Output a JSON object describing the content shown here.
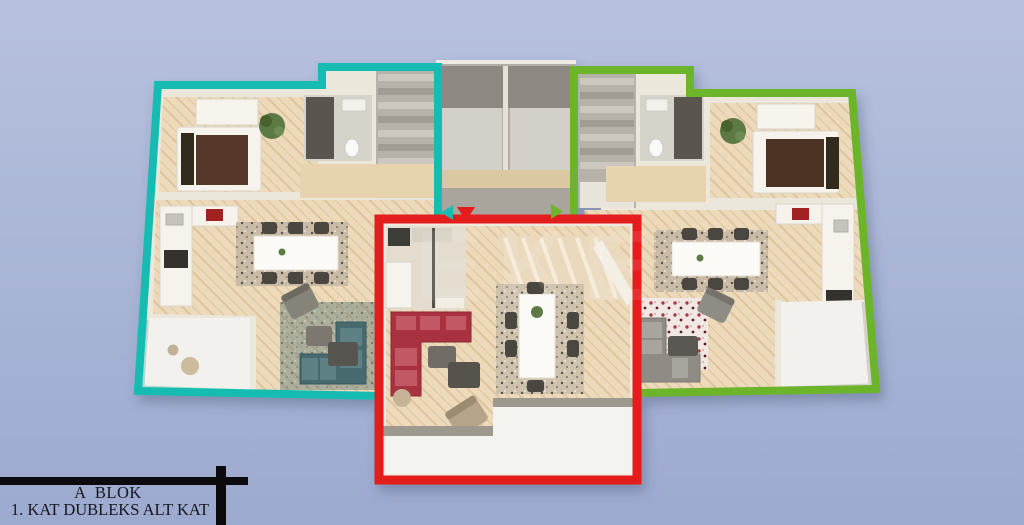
{
  "scene": {
    "description": "3D top-down architectural render of a duplex lower-floor plan with three outlined apartment units",
    "background": {
      "top": "#b7c1de",
      "bottom": "#9daacf"
    },
    "watermark_text": "EKE"
  },
  "title_block": {
    "line1": "A  BLOK",
    "line2": "1. KAT DUBLEKS ALT KAT",
    "text_color": "#15161e",
    "bar_color": "#0b0b0d"
  },
  "units": [
    {
      "name": "left duplex unit",
      "outline_color": "#17bcb2"
    },
    {
      "name": "center duplex unit",
      "outline_color": "#e41d1d"
    },
    {
      "name": "right duplex unit",
      "outline_color": "#6cb42c"
    }
  ],
  "entry_markers": [
    {
      "unit": "left",
      "shape": "triangle-left",
      "color": "#17bcb2"
    },
    {
      "unit": "center",
      "shape": "triangle-down",
      "color": "#e41d1d"
    },
    {
      "unit": "right",
      "shape": "triangle-right",
      "color": "#6cb42c"
    }
  ]
}
